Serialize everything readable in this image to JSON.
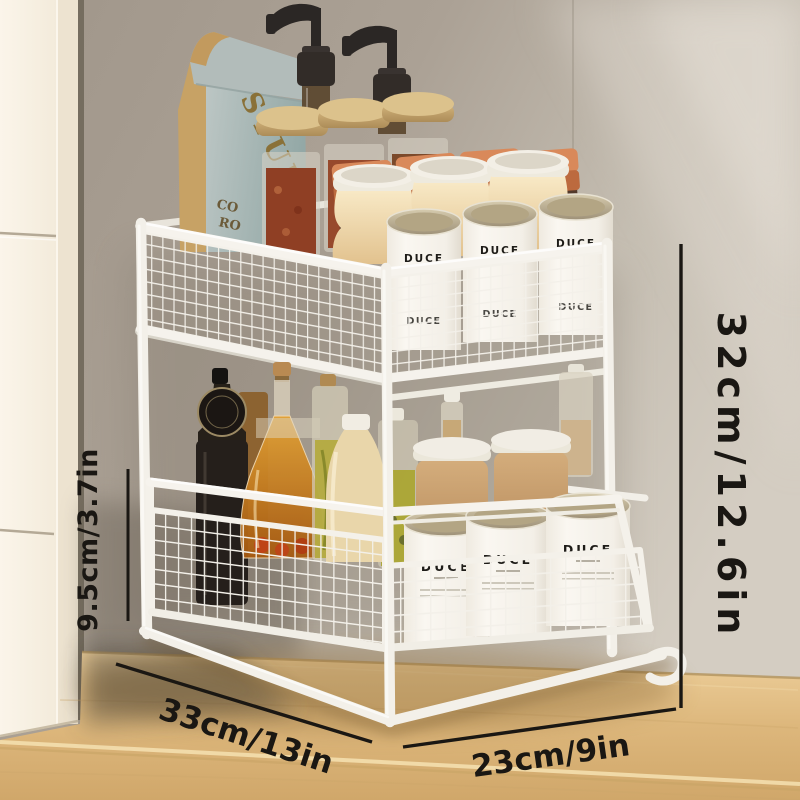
{
  "title": "two-tier pull-out cabinet organizer product photo",
  "annotations": {
    "total_height": "32cm/12.6in",
    "lower_tier_height": "9.5cm/3.7in",
    "depth": "33cm/13in",
    "width": "23cm/9in"
  },
  "products": {
    "coffee_bag": {
      "brand": "STUMP",
      "text_line2": "CO",
      "text_line3": "RO"
    },
    "canister_brand": "DUCE"
  },
  "palette": {
    "annotation_ink": "#1a1713",
    "wall": "#a89e91",
    "cabinet": "#f8f1e4",
    "countertop": "#e4c48d",
    "rack_white": "#f4f1ea",
    "terracotta_lid": "#c97a4c",
    "bamboo_lid": "#c9a96e",
    "cream_jar": "#f0dcae"
  }
}
